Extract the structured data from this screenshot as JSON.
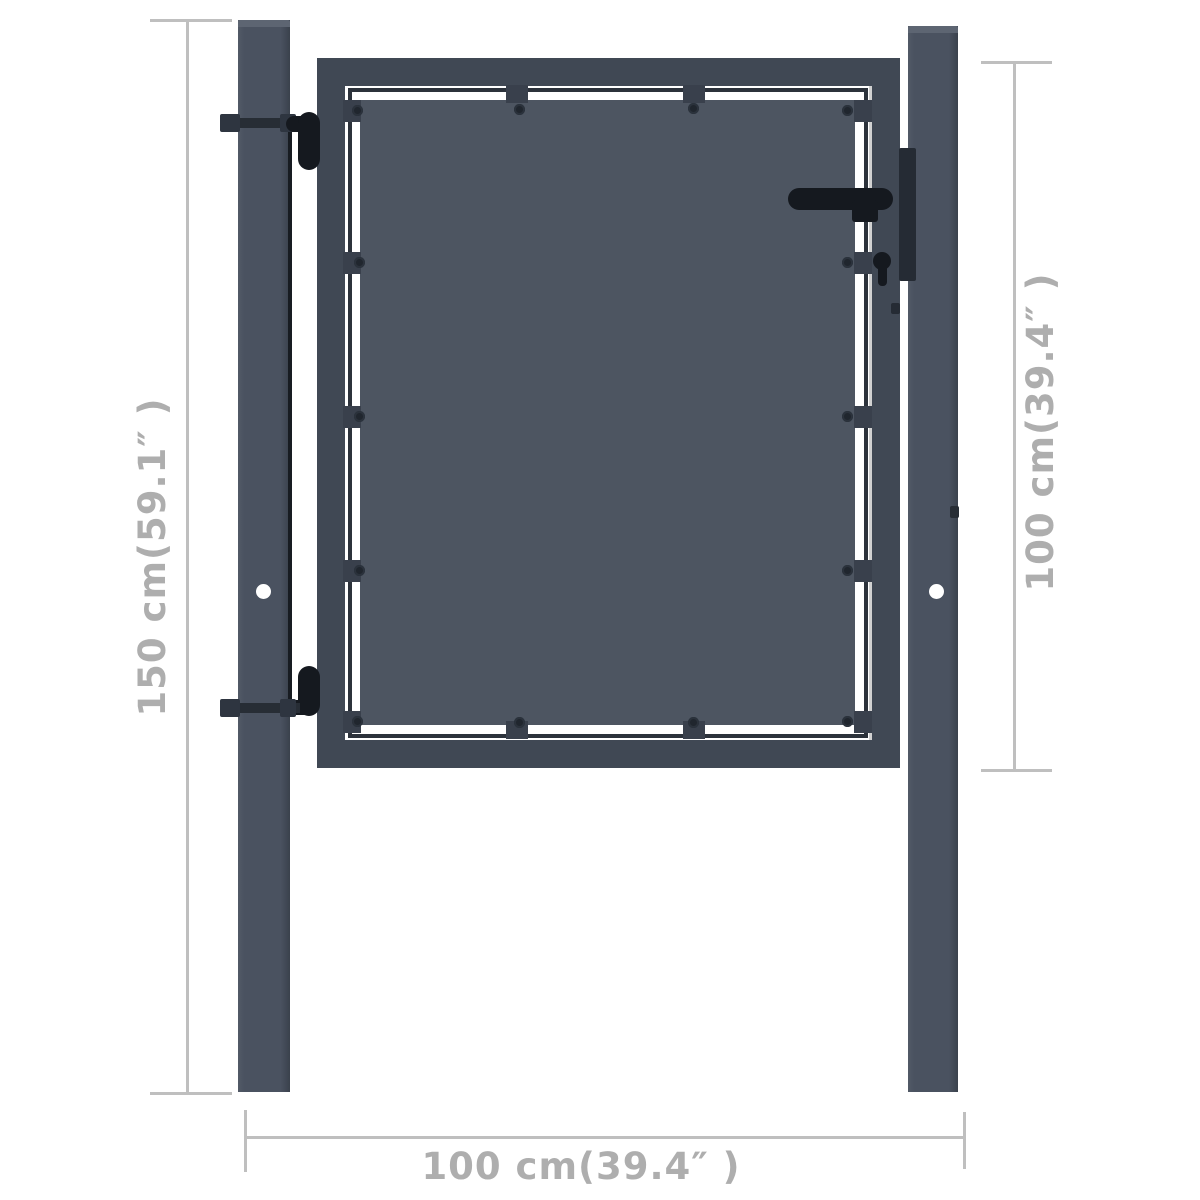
{
  "image": {
    "description": "Product dimension diagram of an anthracite steel garden gate with two square posts",
    "background": "#ffffff"
  },
  "colors": {
    "panel": "#4d5561",
    "frame": "#404854",
    "post": "#4a5260",
    "hardware_black": "#15191f",
    "dimension_line": "#bfbfbf",
    "dimension_text": "#aeaeae"
  },
  "dimensions": {
    "post_height": {
      "label": "150 cm(59.1″ )",
      "orientation": "vertical-left"
    },
    "gate_height": {
      "label": "100 cm(39.4″ )",
      "orientation": "vertical-right"
    },
    "gate_width": {
      "label": "100 cm(39.4″ )",
      "orientation": "horizontal-bottom"
    }
  }
}
